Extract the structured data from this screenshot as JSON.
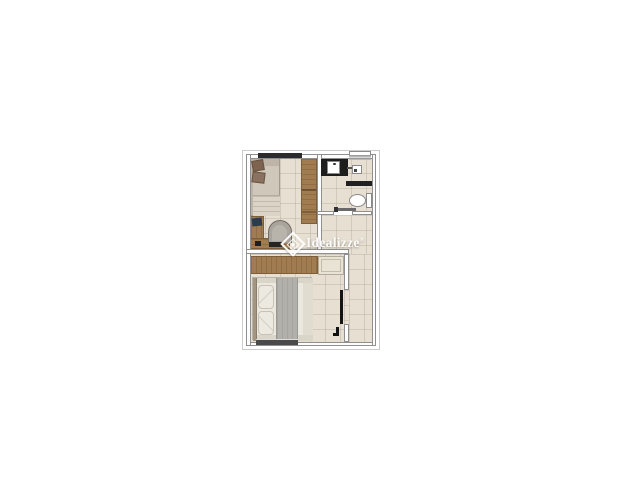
{
  "watermark": {
    "brand": "Idealizze",
    "registered": "®"
  },
  "colors": {
    "bg": "#ffffff",
    "floor": "#e7e0d2",
    "grout": "rgba(160,150,128,0.30)",
    "wall-fill": "#fdfdfd",
    "wall-line": "#8f8f8f",
    "outer-line": "#cccccc",
    "wood": "#a17c50",
    "wood-dark": "#7c5e3a",
    "black-fixture": "#1d1d1d",
    "window-dark": "#2b2b2b",
    "window-bottom": "#4a4a4a",
    "sofa": "#beb5a8",
    "sofa-mattress": "#cfc8ba",
    "pillow-brown": "#7d6350",
    "pillow-brown2": "#8a7260",
    "blanket": "#dbd4c6",
    "chair": "#a9a49c",
    "laptop": "#2f3a4f",
    "bed-duvet": "#ebe8e0",
    "bed-runner": "#b2b0aa",
    "bed-fold": "#d9d5c8",
    "headboard": "#a3957f",
    "cabinet-cream": "#e8e3d4"
  }
}
